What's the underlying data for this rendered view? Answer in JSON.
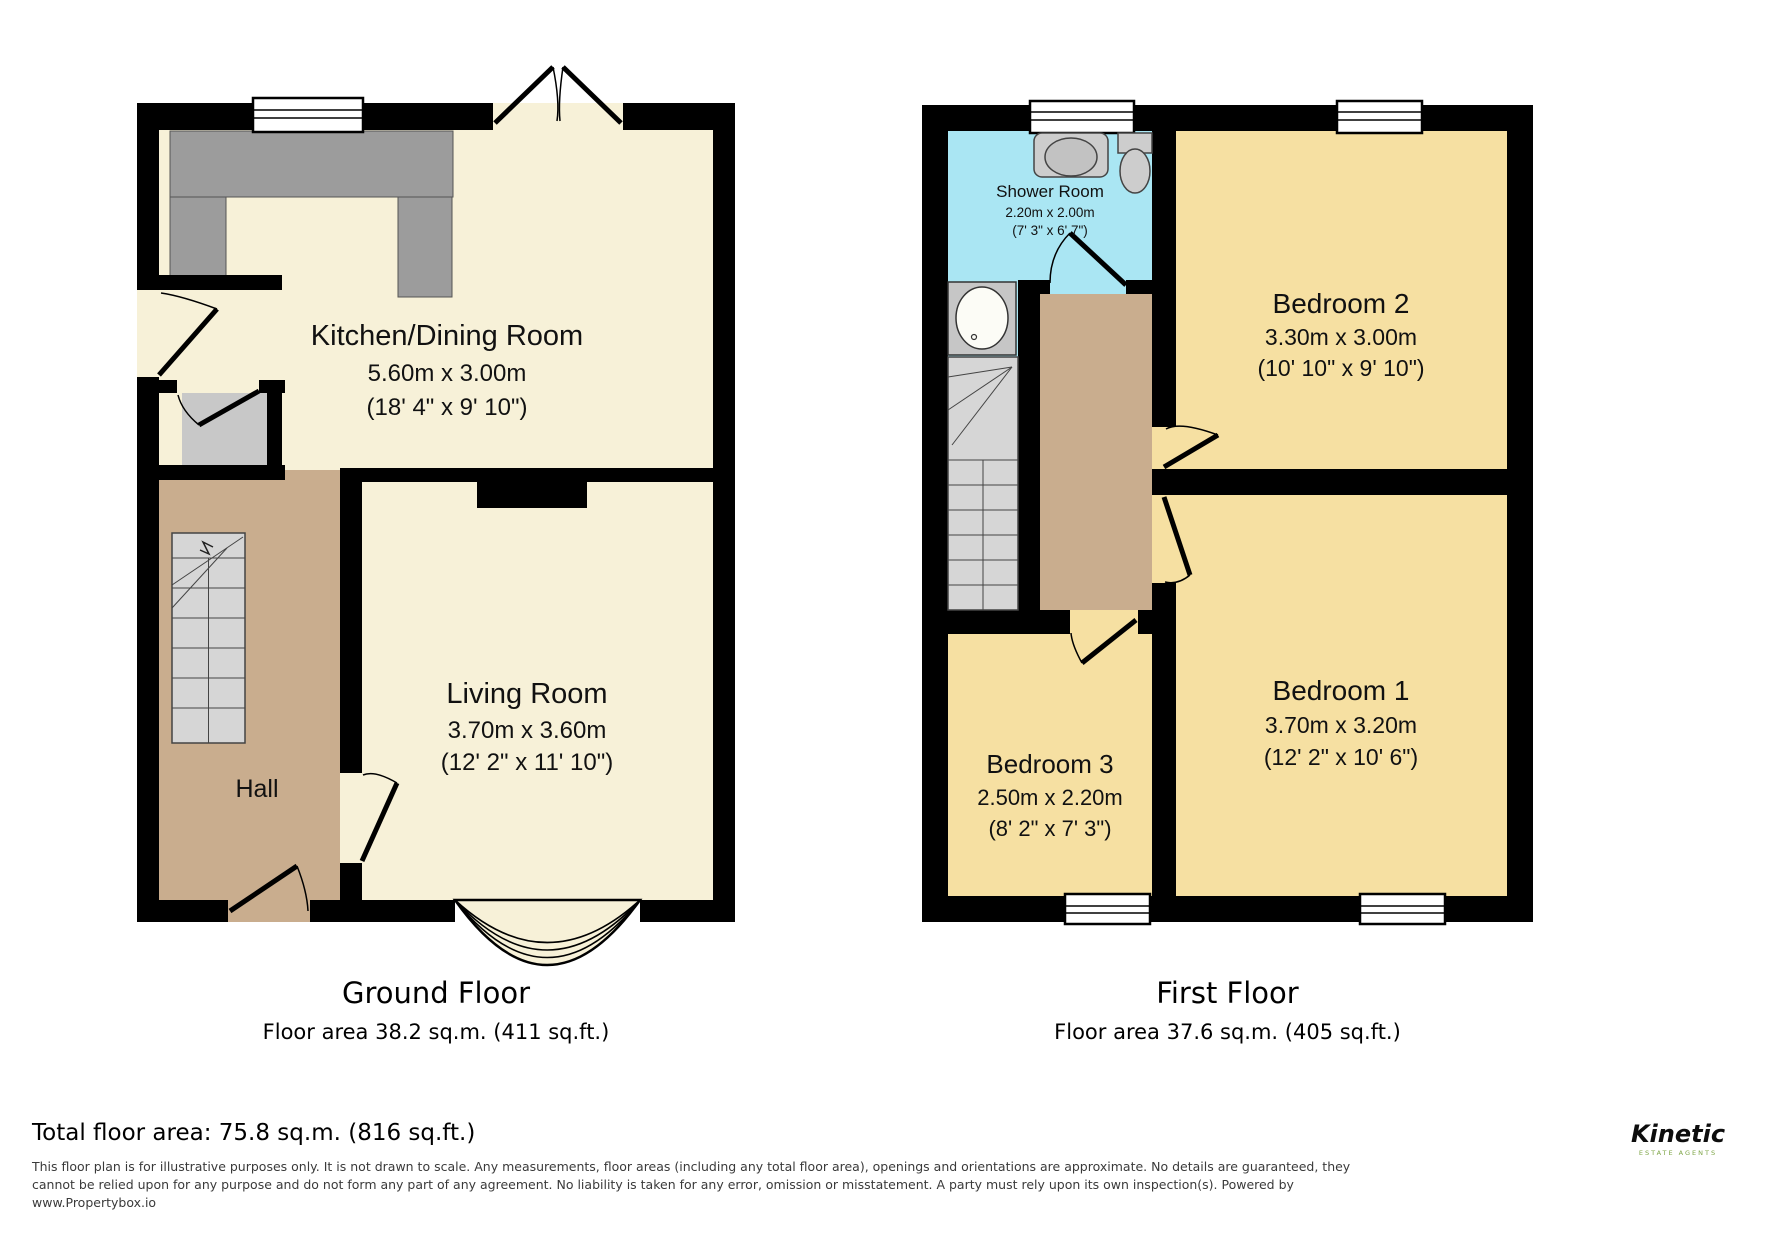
{
  "ground": {
    "title": "Ground Floor",
    "area_label": "Floor area 38.2 sq.m. (411 sq.ft.)",
    "rooms": {
      "kitchen": {
        "name": "Kitchen/Dining Room",
        "metric": "5.60m x 3.00m",
        "imperial": "(18' 4\" x 9' 10\")"
      },
      "living": {
        "name": "Living Room",
        "metric": "3.70m x 3.60m",
        "imperial": "(12' 2\" x 11' 10\")"
      },
      "hall": {
        "name": "Hall"
      }
    }
  },
  "first": {
    "title": "First Floor",
    "area_label": "Floor area 37.6 sq.m. (405 sq.ft.)",
    "rooms": {
      "shower": {
        "name": "Shower Room",
        "metric": "2.20m x 2.00m",
        "imperial": "(7' 3\" x 6' 7\")"
      },
      "bedroom2": {
        "name": "Bedroom 2",
        "metric": "3.30m x 3.00m",
        "imperial": "(10' 10\" x 9' 10\")"
      },
      "bedroom1": {
        "name": "Bedroom 1",
        "metric": "3.70m x 3.20m",
        "imperial": "(12' 2\" x 10' 6\")"
      },
      "bedroom3": {
        "name": "Bedroom 3",
        "metric": "2.50m x 2.20m",
        "imperial": "(8' 2\" x 7' 3\")"
      }
    }
  },
  "footer": {
    "total_area": "Total floor area: 75.8 sq.m. (816 sq.ft.)",
    "disclaimer": "This floor plan is for illustrative purposes only. It is not drawn to scale. Any measurements, floor areas (including any total floor area), openings and orientations are approximate. No details are guaranteed, they cannot be relied upon for any purpose and do not form any part of any agreement. No liability is taken for any error, omission or misstatement. A party must rely upon its own inspection(s). Powered by www.Propertybox.io",
    "brand": {
      "name": "Kinetic",
      "tagline": "ESTATE AGENTS"
    }
  },
  "colors": {
    "wall": "#000000",
    "cream_floor": "#f7f1d8",
    "hall_tan": "#c9ad8e",
    "bedroom_yellow": "#f6e0a2",
    "shower_blue": "#aae6f3",
    "counter_gray": "#9c9c9c",
    "store_gray": "#c8c8c8",
    "stair_gray": "#d6d6d6",
    "logo_green": "#8bc53f"
  }
}
